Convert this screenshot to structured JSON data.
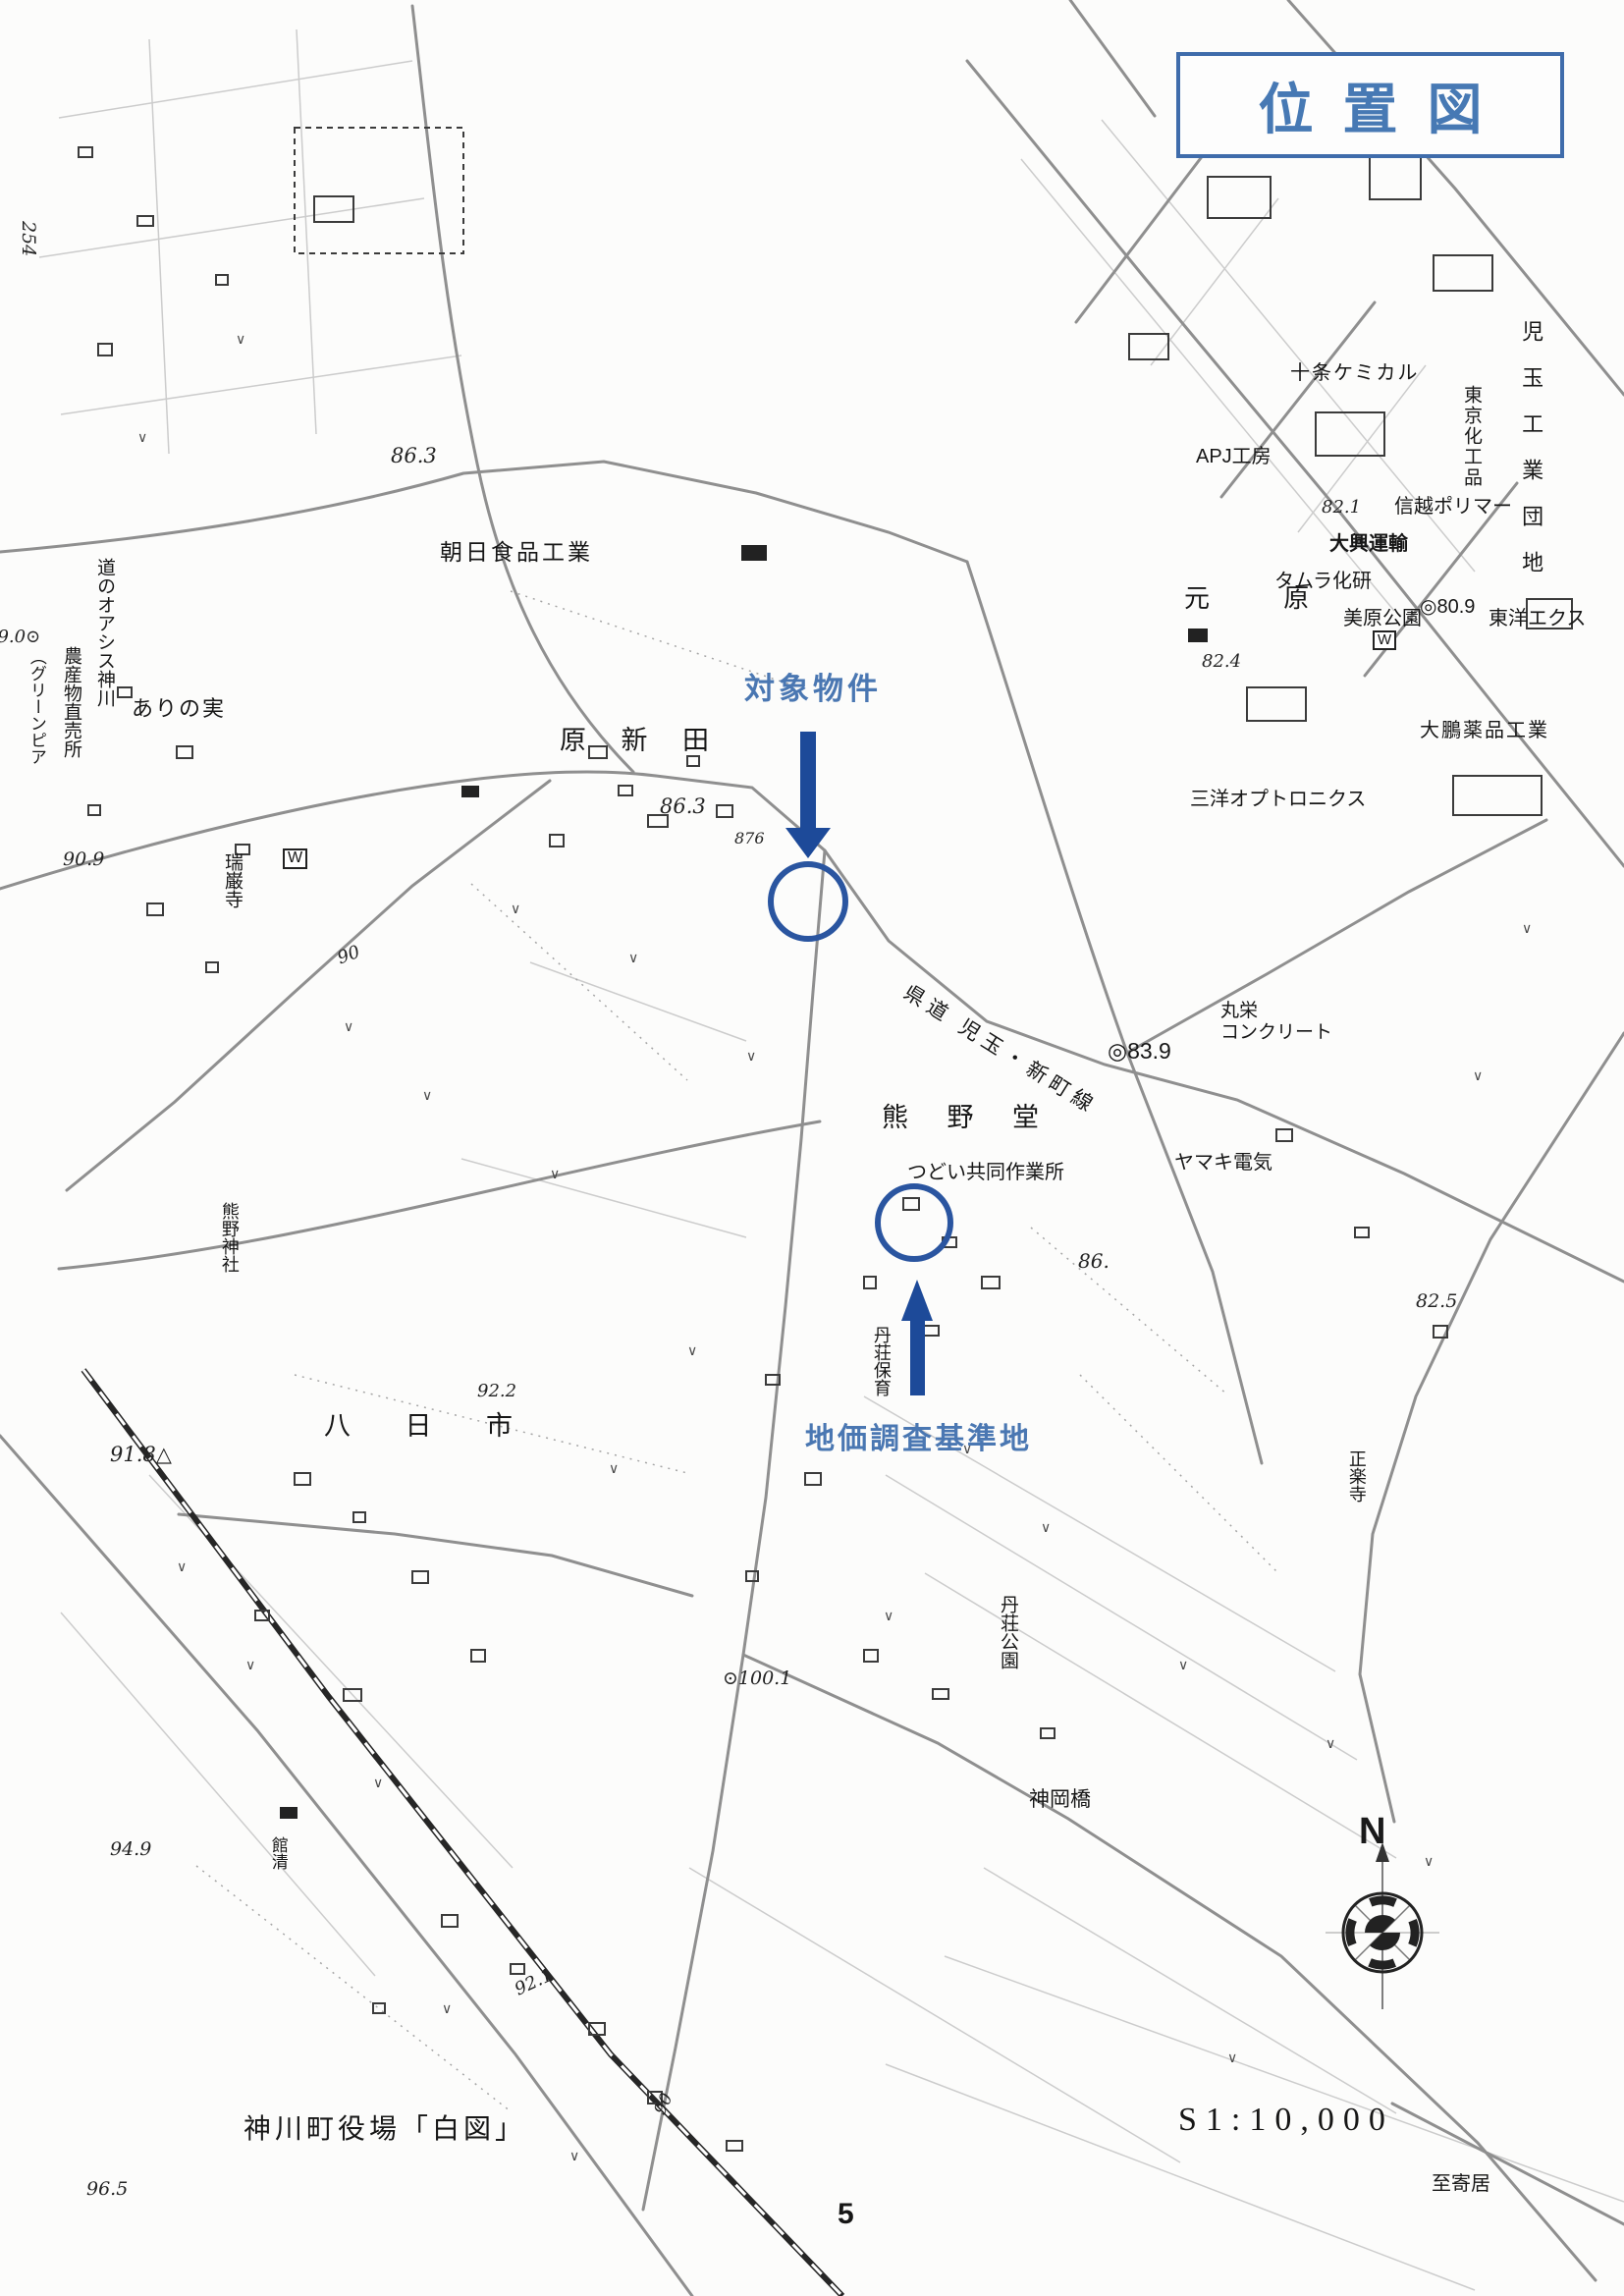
{
  "title_box": {
    "text": "位置図"
  },
  "annotations": {
    "target_property": "対象物件",
    "survey_site": "地価調査基準地"
  },
  "compass": {
    "north": "N"
  },
  "footer": {
    "source": "神川町役場「白図」",
    "scale": "S1:10,000",
    "page_number": "5",
    "direction": "至寄居"
  },
  "labels": {
    "jujo_chemical": "十条ケミカル",
    "apj_kobo": "APJ工房",
    "tokyo_kakohin": "東京化工品",
    "kodama_danchi": "児玉工業団地",
    "shinetsu_polymer": "信越ポリマー",
    "daiko_unyu": "大興運輸",
    "tamura_kaken": "タムラ化研",
    "motohara": "元 原",
    "mihara_park": "美原公園",
    "toyo_ex": "東洋エクス",
    "taiho_pharma": "大鵬薬品工業",
    "sanyo_opto": "三洋オプトロニクス",
    "asahi_foods": "朝日食品工業",
    "michi_no_oasis": "道のオアシス神川",
    "nousanbutsu": "農産物直売所",
    "greenpia": "（グリーンピア",
    "arinomi": "ありの実",
    "hara_shinden": "原 新 田",
    "zuiganji": "瑞巌寺",
    "kumano_jinja": "熊野神社",
    "kumanodo": "熊 野 堂",
    "kendo_route": "県道 児玉・新町線",
    "maruei_line1": "丸栄",
    "maruei_line2": "コンクリート",
    "tsudoi": "つどい共同作業所",
    "yamaki_denki": "ヤマキ電気",
    "shorakuji": "正楽寺",
    "tanso_hoiku": "丹荘保育",
    "yokaichi": "八 日 市",
    "tanso_koen": "丹荘公園",
    "kamioka_bridge": "神岡橋",
    "yakata": "館清",
    "water_w": "W"
  },
  "elevations": {
    "e254": "254",
    "e863_nw": "86.3",
    "e890": "89.0⊙",
    "e909": "90.9",
    "e90_mid": "90",
    "e863_shinden": "86.3",
    "e876": "876",
    "e839": "◎83.9",
    "e809": "◎80.9",
    "e821": "82.1",
    "e824": "82.4",
    "e86": "86.",
    "e825": "82.5",
    "e918": "91.8△",
    "e922": "92.2",
    "e1001": "⊙100.1",
    "e949": "94.9",
    "e921": "92.1",
    "e90_s": "90",
    "e965": "96.5"
  },
  "colors": {
    "annotation_blue": "#1d4a99",
    "circle_blue": "#2a55a0",
    "title_blue": "#4779b4",
    "map_ink": "#161616"
  }
}
